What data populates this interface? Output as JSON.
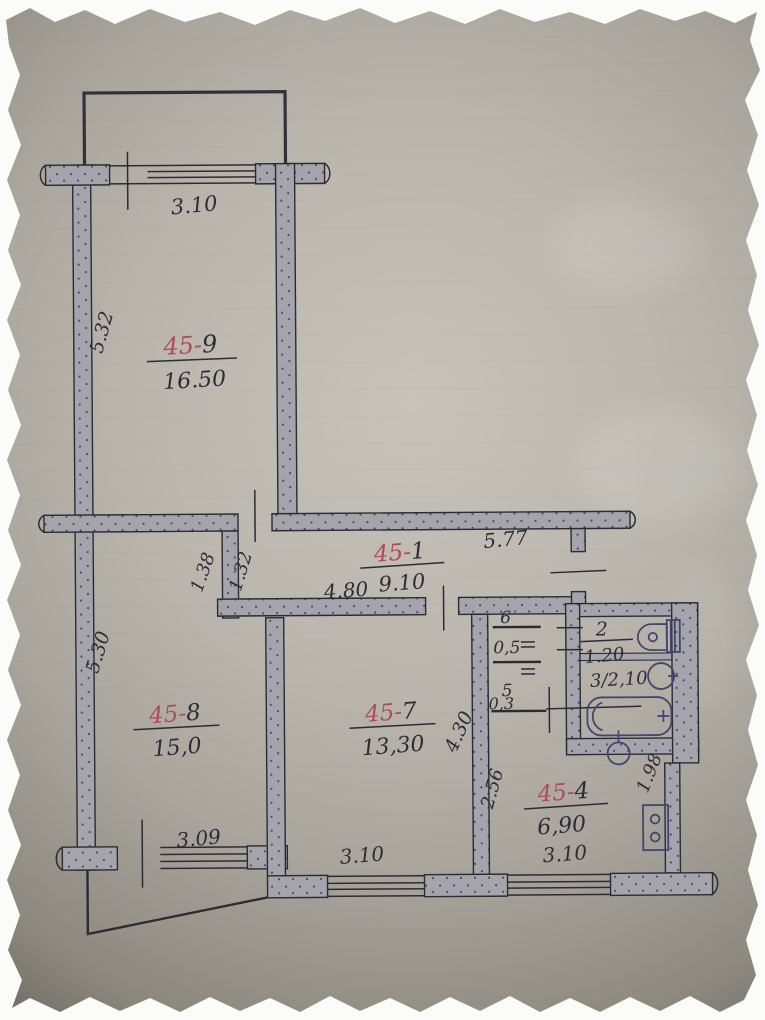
{
  "document": {
    "type": "hand-drawn apartment floor plan photo",
    "colors": {
      "ink": "#2c2b34",
      "red_ink": "#b04a5e",
      "blue_ink": "#45456e",
      "paper": "#bab6ad",
      "wall_fill": "#a5a4ad"
    }
  },
  "rooms": [
    {
      "prefix": "45-",
      "suffix": "9",
      "area": "16.50"
    },
    {
      "prefix": "45-",
      "suffix": "1",
      "area": "9.10"
    },
    {
      "prefix": "45-",
      "suffix": "8",
      "area": "15,0"
    },
    {
      "prefix": "45-",
      "suffix": "7",
      "area": "13,30"
    },
    {
      "prefix": "45-",
      "suffix": "4",
      "area": "6,90"
    }
  ],
  "small_rooms": {
    "wc_label": "2",
    "wc_area": "1.20",
    "bath_label": "3/2,10",
    "closet6_label": "6",
    "closet6_area": "0,5",
    "closet5_label": "5",
    "closet5_area": "0,3"
  },
  "dimensions": {
    "top_window": "3.10",
    "left_upper_wall": "5.32",
    "hall_top": "5.77",
    "hall_bottom": "4.80",
    "niche_left": "1.38",
    "niche_right": "1.32",
    "left_lower_wall": "5.30",
    "room8_window": "3.09",
    "room7_side": "4.30",
    "kitchen_side": "2.56",
    "room7_window": "3.10",
    "kitchen_window": "3.10",
    "kitchen_right": "1.98"
  }
}
